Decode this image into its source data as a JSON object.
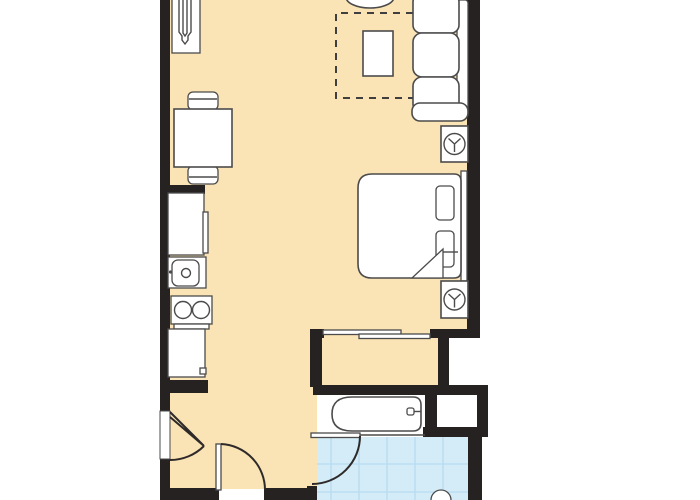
{
  "palette": {
    "background": "#ffffff",
    "floor": "#fae3b4",
    "wall": "#272222",
    "outline": "#4b4b4b",
    "furniture": "#ffffff",
    "tile": "#d4ecf8",
    "tilegrid": "#bbddf0",
    "dash": "#3f3f3f"
  },
  "plan": {
    "type": "apartment-floor-plan",
    "rooms": [
      {
        "id": "living-dining-area",
        "floor": "cream"
      },
      {
        "id": "sleeping-area",
        "floor": "cream"
      },
      {
        "id": "kitchenette-nook",
        "floor": "cream"
      },
      {
        "id": "entry-area",
        "floor": "cream"
      },
      {
        "id": "closet",
        "floor": "cream",
        "feature": "sliding-doors"
      },
      {
        "id": "tub-alcove",
        "floor": "white"
      },
      {
        "id": "bathroom",
        "floor": "blue-tile"
      },
      {
        "id": "storage-closet",
        "floor": "white"
      }
    ],
    "furniture": [
      "ironing-board-cabinet",
      "dining-table",
      "dining-chair-top",
      "dining-chair-bottom",
      "partial-chair",
      "area-rug-dashed",
      "coffee-table",
      "sofa-three-cushion",
      "lamp-end-table-1",
      "lamp-end-table-2",
      "refrigerator",
      "kitchen-sink",
      "two-burner-stove",
      "base-cabinet",
      "bed",
      "pillow-1",
      "pillow-2",
      "headboard",
      "blanket-fold",
      "sliding-closet-door-1",
      "sliding-closet-door-2",
      "bathtub",
      "tub-faucet",
      "bathroom-sink",
      "entry-door",
      "interior-door",
      "bathroom-door"
    ]
  }
}
